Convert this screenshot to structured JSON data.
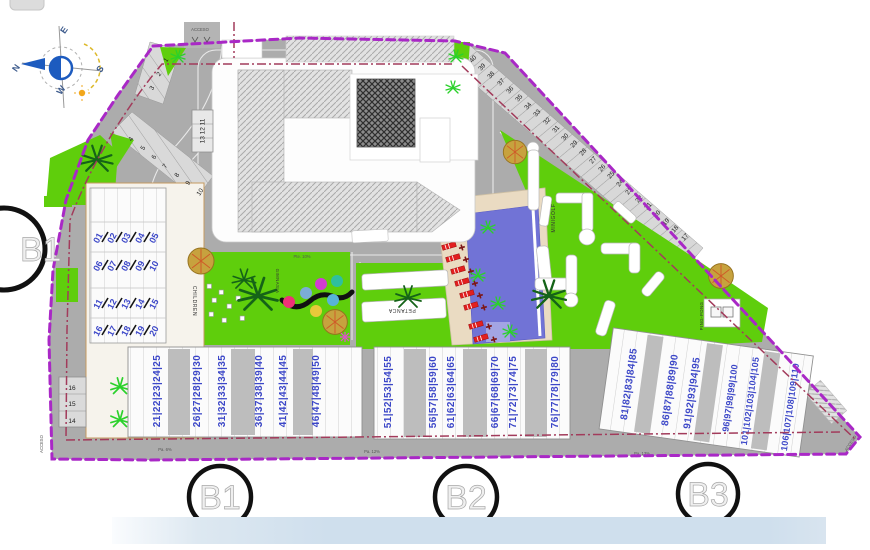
{
  "title": "Residential site plan",
  "colors": {
    "boundary_purple": "#a928c6",
    "inner_line_maroon": "#a23b5b",
    "road_gray": "#acacac",
    "green": "#5fce0c",
    "pool_blue": "#7173d6",
    "deck_beige": "#eadbc2",
    "plot_number_blue": "#3c47c8",
    "lounger_red": "#e21f1f",
    "bottom_bar_blue": "#cfdfed",
    "gym_dots": [
      "#ee3377",
      "#7bacd8",
      "#d23bd2",
      "#2fbf9f",
      "#58b3d8",
      "#e8c93a"
    ]
  },
  "compass": {
    "n": "N",
    "e": "E",
    "s": "S",
    "w": "W"
  },
  "access": {
    "top": "ACCESO",
    "bottom_left": "ACCESO",
    "bottom_right": "ACCESO"
  },
  "amenities": {
    "minigolf": "MINIGOLF",
    "ping_pong": "PING-PONG",
    "petanca": "PETANCA",
    "children": "CHILDREN",
    "gym": "GIMNASIA"
  },
  "markers": {
    "side": "B1",
    "b1": "B1",
    "b2": "B2",
    "b3": "B3"
  },
  "left_block_rows": [
    [
      "01",
      "02",
      "03",
      "04",
      "05"
    ],
    [
      "06",
      "07",
      "08",
      "09",
      "10"
    ],
    [
      "11",
      "12",
      "13",
      "14",
      "15"
    ],
    [
      "16",
      "17",
      "18",
      "19",
      "20"
    ]
  ],
  "stall_box_label": "13 12 11",
  "side_stalls": [
    "16",
    "15",
    "14"
  ],
  "upper_stalls": [
    "1",
    "2",
    "3",
    "4",
    "5",
    "6",
    "7",
    "8",
    "9",
    "10"
  ],
  "diagonal_stalls": [
    "40",
    "39",
    "38",
    "37",
    "36",
    "35",
    "34",
    "33",
    "32",
    "31",
    "30",
    "29",
    "28",
    "27",
    "26",
    "25",
    "24",
    "23",
    "22",
    "21",
    "20",
    "19",
    "18",
    "17"
  ],
  "bottom_groups": [
    "21|22|23|24|25",
    "26|27|28|29|30",
    "31|32|33|34|35",
    "36|37|38|39|40",
    "41|42|43|44|45",
    "46|47|48|49|50",
    "51|52|53|54|55",
    "56|57|58|59|60",
    "61|62|63|64|65",
    "66|67|68|69|70",
    "71|72|73|74|75",
    "76|77|78|79|80",
    "81|82|83|84|85",
    "86|87|88|89|90",
    "91|92|93|94|95",
    "96|97|98|99|100",
    "101|102|103|104|105",
    "106|107|108|109|110"
  ],
  "road_labels": {
    "left": "Pa. 6%",
    "mid": "Pa. 12%",
    "right": "Pa. 13%",
    "top": "Pte. 10%"
  }
}
